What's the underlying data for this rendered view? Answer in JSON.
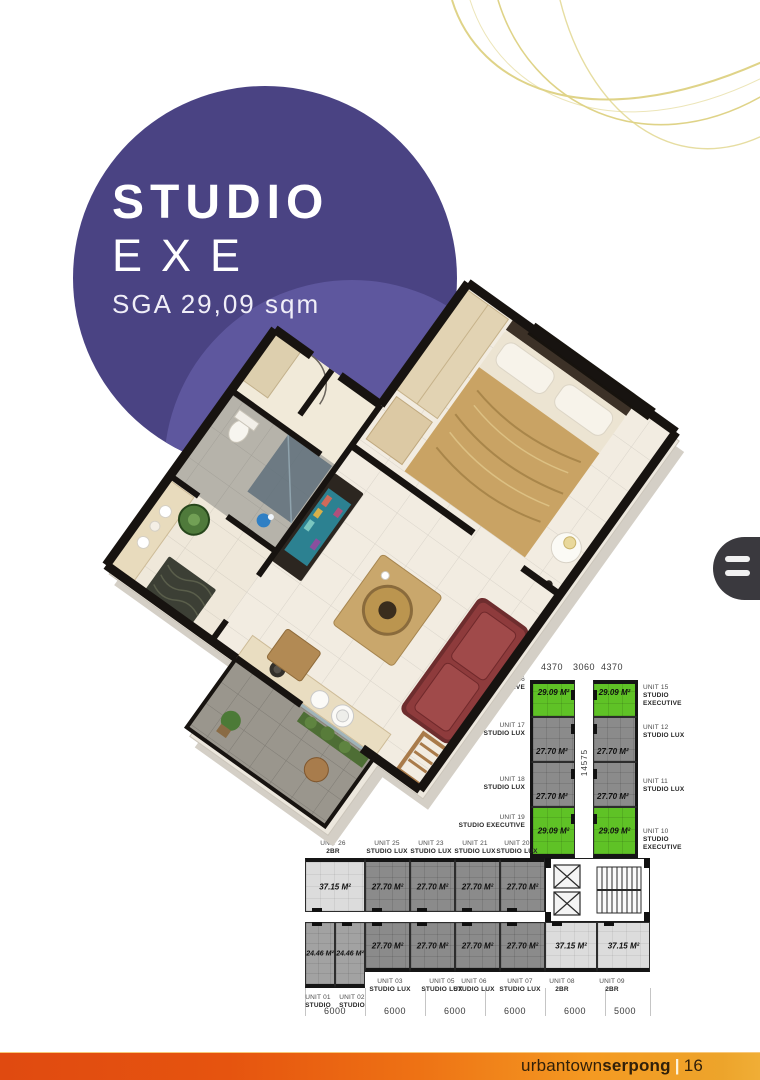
{
  "hero": {
    "title": "STUDIO",
    "subtitle": "EXE",
    "area_label": "SGA 29,09 sqm"
  },
  "decor": {
    "circle_color": "#4a4383",
    "circle_inner_color": "#615aa1",
    "swirl_color": "#dccf7c"
  },
  "side_tab": {
    "icon": "menu-handle-icon"
  },
  "floor_plate": {
    "top_dimensions": [
      "4370",
      "3060",
      "4370"
    ],
    "vertical_dimension": "14575",
    "bottom_dimensions": [
      "6000",
      "6000",
      "6000",
      "6000",
      "6000",
      "5000"
    ],
    "highlight_color": "#5fc226",
    "vertical_wing": {
      "left_units": [
        {
          "unit": "UNIT 16",
          "type": "STUDIO EXECUTIVE",
          "area": "29.09 M²",
          "highlight": true
        },
        {
          "unit": "UNIT 17",
          "type": "STUDIO LUX",
          "area": "27.70 M²",
          "highlight": false
        },
        {
          "unit": "UNIT 18",
          "type": "STUDIO LUX",
          "area": "27.70 M²",
          "highlight": false
        },
        {
          "unit": "UNIT 19",
          "type": "STUDIO EXECUTIVE",
          "area": "29.09 M²",
          "highlight": true
        }
      ],
      "right_units": [
        {
          "unit": "UNIT 15",
          "type": "STUDIO EXECUTIVE",
          "area": "29.09 M²",
          "highlight": true
        },
        {
          "unit": "UNIT 12",
          "type": "STUDIO LUX",
          "area": "27.70 M²",
          "highlight": false
        },
        {
          "unit": "UNIT 11",
          "type": "STUDIO LUX",
          "area": "27.70 M²",
          "highlight": false
        },
        {
          "unit": "UNIT 10",
          "type": "STUDIO EXECUTIVE",
          "area": "29.09 M²",
          "highlight": true
        }
      ]
    },
    "horizontal_wing": {
      "top_row": {
        "labels": [
          {
            "unit": "UNIT 26",
            "type": "2BR"
          },
          {
            "unit": "UNIT 25",
            "type": "STUDIO LUX"
          },
          {
            "unit": "UNIT 23",
            "type": "STUDIO LUX"
          },
          {
            "unit": "UNIT 21",
            "type": "STUDIO LUX"
          },
          {
            "unit": "UNIT 20",
            "type": "STUDIO LUX"
          }
        ],
        "areas": [
          "37.15 M²",
          "27.70 M²",
          "27.70 M²",
          "27.70 M²",
          "27.70 M²"
        ]
      },
      "bottom_row": {
        "labels": [
          {
            "unit": "UNIT 01",
            "type": "STUDIO"
          },
          {
            "unit": "UNIT 02",
            "type": "STUDIO"
          },
          {
            "unit": "UNIT 03",
            "type": "STUDIO LUX"
          },
          {
            "unit": "UNIT 05",
            "type": "STUDIO LUX"
          },
          {
            "unit": "UNIT 06",
            "type": "STUDIO LUX"
          },
          {
            "unit": "UNIT 07",
            "type": "STUDIO LUX"
          },
          {
            "unit": "UNIT 08",
            "type": "2BR"
          },
          {
            "unit": "UNIT 09",
            "type": "2BR"
          }
        ],
        "areas": [
          "24.46 M²",
          "24.46 M²",
          "27.70 M²",
          "27.70 M²",
          "27.70 M²",
          "27.70 M²",
          "37.15 M²",
          "37.15 M²"
        ]
      }
    }
  },
  "footer": {
    "brand_regular": "urbantown",
    "brand_bold": "serpong",
    "separator": "|",
    "page_number": "16",
    "bar_left_color": "#e04a10",
    "bar_right_color": "#eda42b"
  }
}
